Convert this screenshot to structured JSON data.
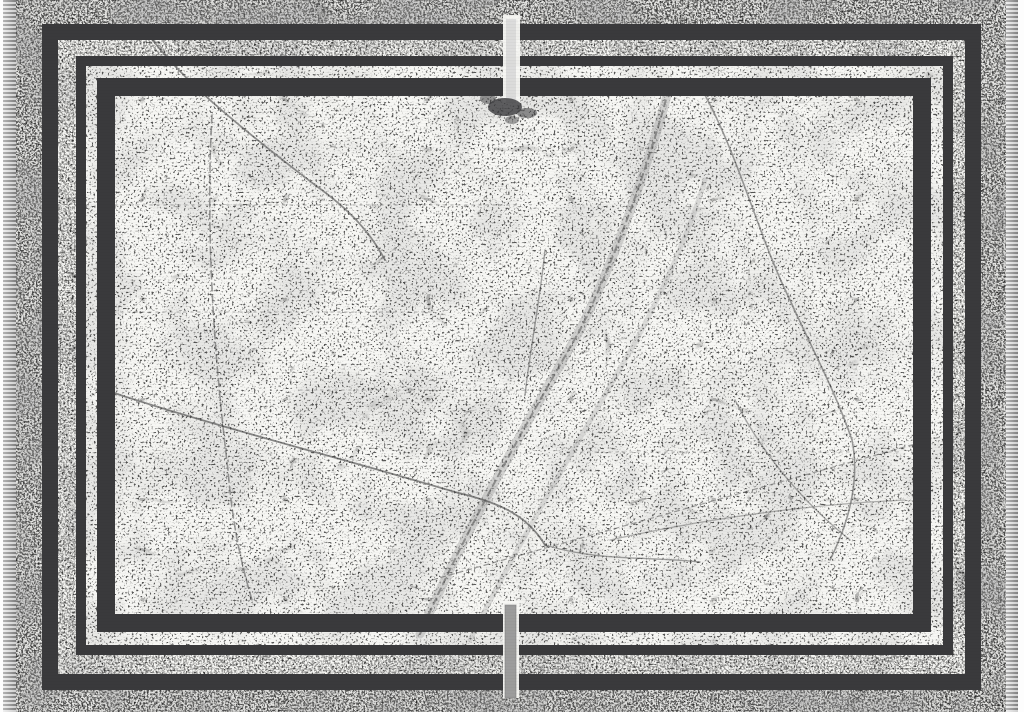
{
  "meta": {
    "title": "Distressed monochrome area rug with triple border frames",
    "description": "Top-down product photo of a black and white vintage-distressed rug. White marble-crack textured field, three nested dark charcoal rectangular border frames (thick, thin, thick), dense gray speckled outer margin, gray fringe tassels along the left and right edges, and a narrow vertical slit interrupting the frames at the top and bottom center."
  },
  "colors": {
    "field": "#f7f7f4",
    "frame": "#3a3a3c",
    "fringe": "#8d8d8d",
    "fringe_light": "#e6e6e6",
    "margin_tint": "#a0a0a0",
    "crack": "#4a4a4a",
    "vein": "#9a9a9a",
    "gap_bar_top": "#d7d7d7",
    "gap_bar_bottom": "#979797",
    "backdrop": "#fdfdfd"
  },
  "elements": {
    "border_frame_count": 3,
    "fringe_sides": [
      "left",
      "right"
    ],
    "center_slits": [
      "top",
      "bottom"
    ],
    "texture": "distressed marble cracks and speckle"
  }
}
